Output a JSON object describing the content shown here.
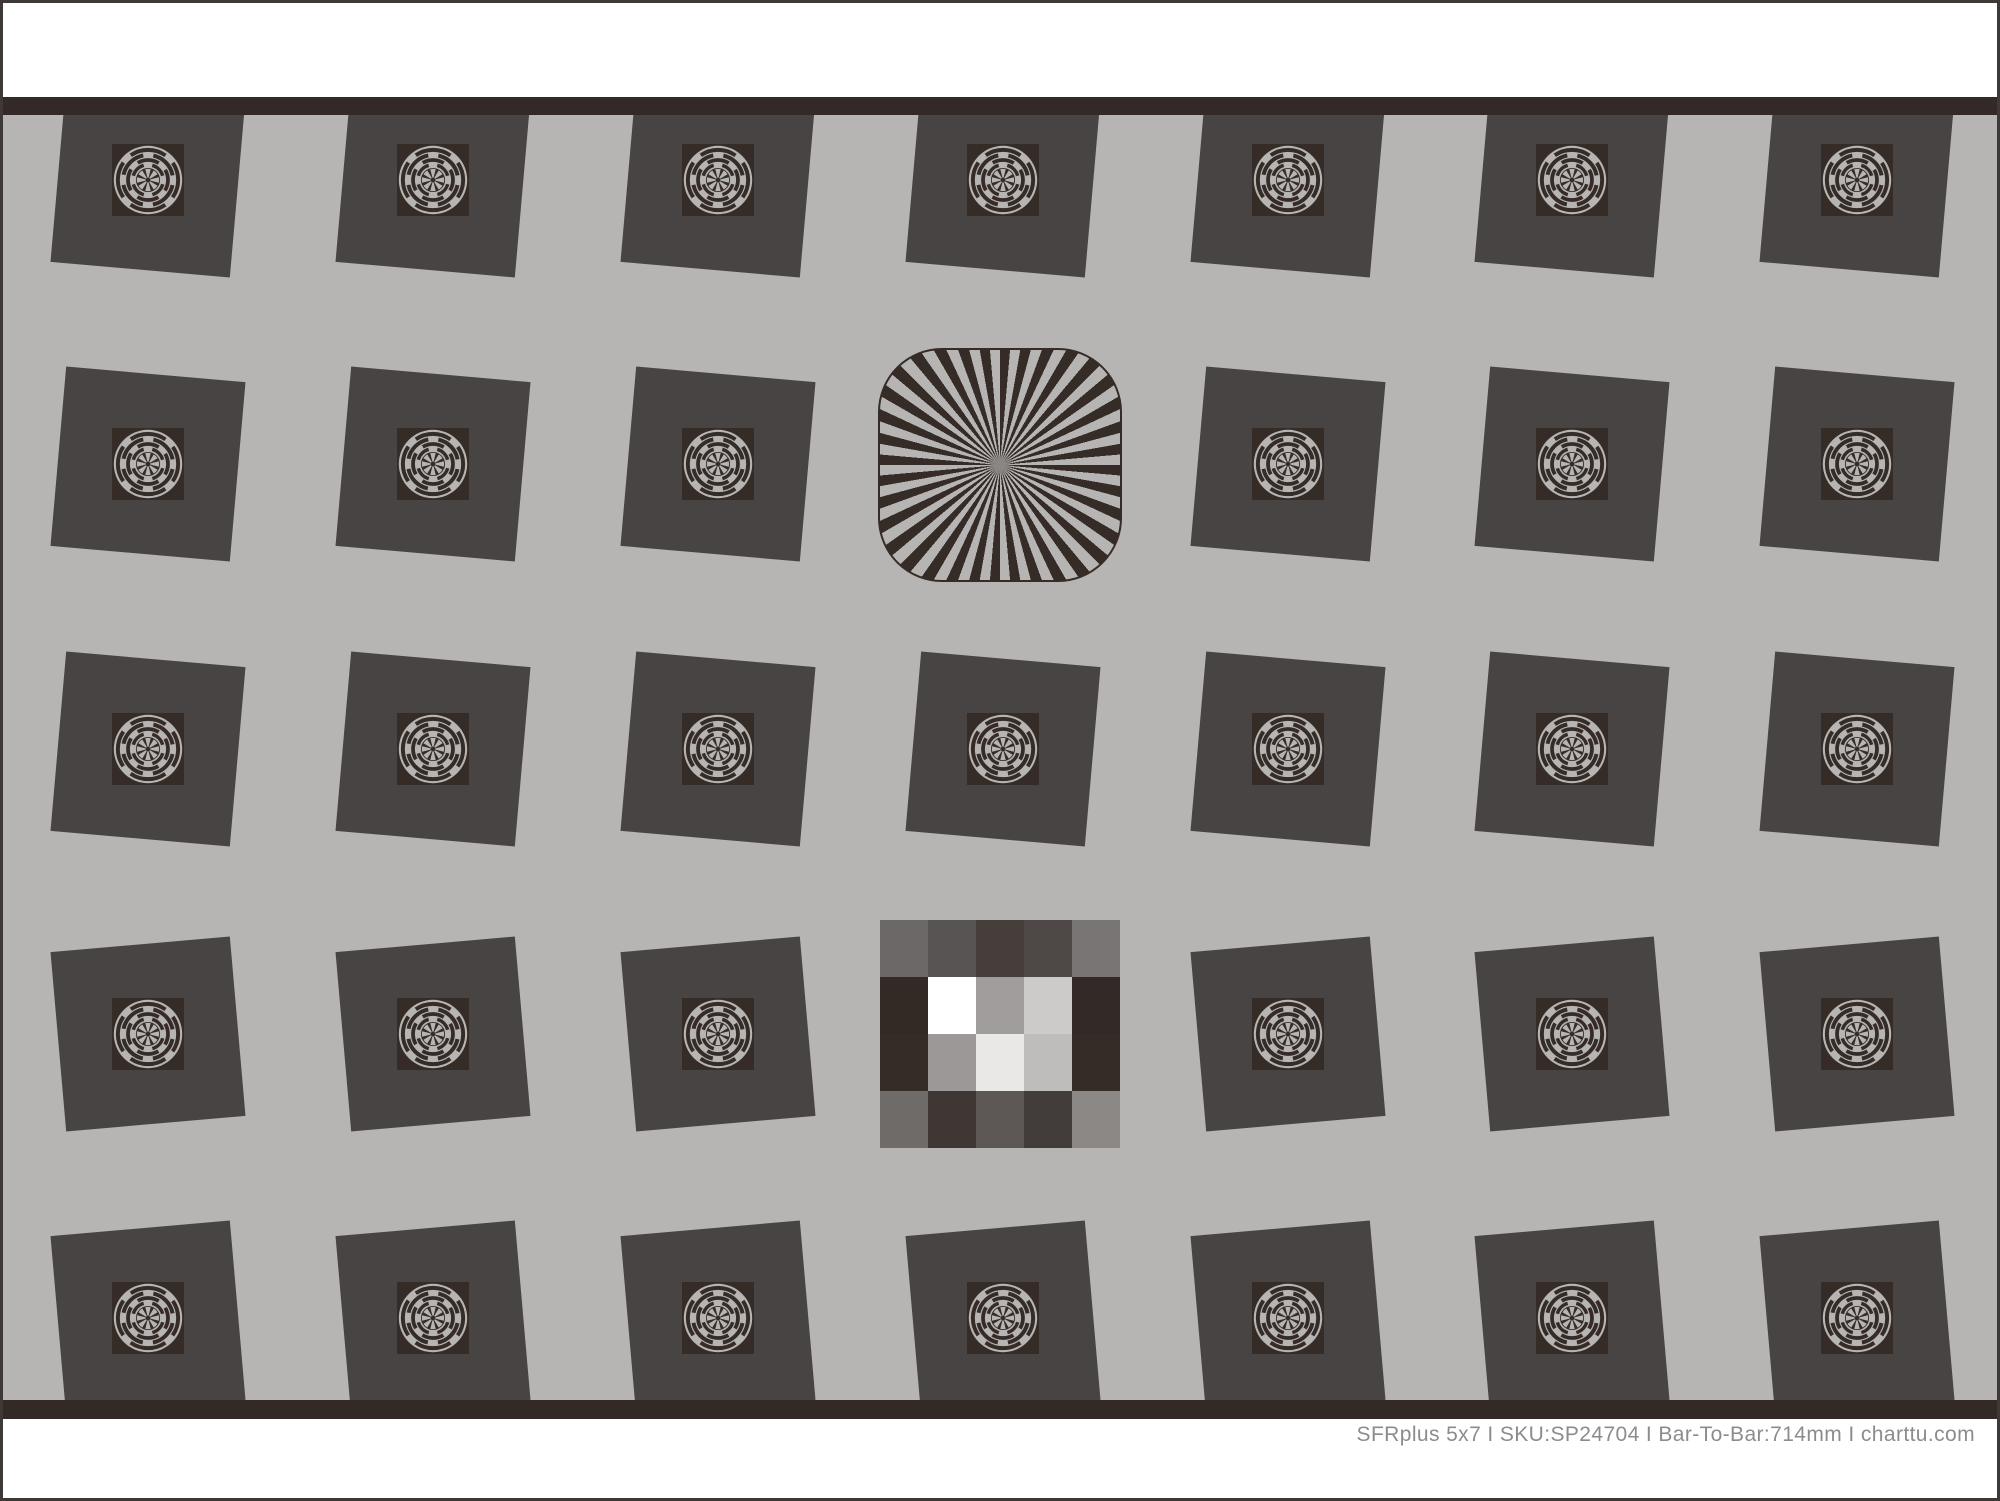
{
  "page": {
    "background": "#ffffff",
    "border_color": "#3e3937",
    "field_color": "#b7b5b3",
    "bar_color": "#332927"
  },
  "chart_info": {
    "name": "SFRplus 5x7",
    "sku": "SP24704",
    "bar_to_bar": "714mm",
    "website": "charttu.com"
  },
  "footer": {
    "label": "SFRplus 5x7 I SKU:SP24704 I Bar-To-Bar:714mm I charttu.com",
    "color": "#8e8b8a"
  },
  "grid": {
    "rows": 5,
    "cols": 7,
    "col_centers_x": [
      145,
      430,
      715,
      1000,
      1285,
      1569,
      1854
    ],
    "row_centers_y": [
      65,
      349,
      634,
      919,
      1203
    ],
    "square_size": 180,
    "square_color": "#484443",
    "tilt_deg_by_row": [
      5,
      5,
      5,
      -5,
      -5
    ],
    "special": {
      "star": [
        1,
        3
      ],
      "checker": [
        3,
        3
      ]
    }
  },
  "regmark": {
    "dark": "#362c27",
    "light": "#b7b5b3"
  },
  "star": {
    "x": 875,
    "y": 233,
    "width": 244,
    "height": 234,
    "border_radius": 64,
    "segments": 36,
    "dark": "#362c27",
    "light": "#b7b5b3",
    "center_dot": "#8a8683"
  },
  "checker": {
    "x": 877,
    "y": 805,
    "cell_w": 48,
    "cell_h": 57,
    "rows": [
      [
        "#6b6867",
        "#585453",
        "#453e3b",
        "#4e4946",
        "#787574"
      ],
      [
        "#332a26",
        "#ffffff",
        "#a09d9c",
        "#cdcbca",
        "#332a27"
      ],
      [
        "#352c27",
        "#9b9897",
        "#e9e8e7",
        "#bfbdbc",
        "#342c27"
      ],
      [
        "#6e6b69",
        "#3e3734",
        "#5d5856",
        "#423d3b",
        "#8b8886"
      ]
    ]
  }
}
